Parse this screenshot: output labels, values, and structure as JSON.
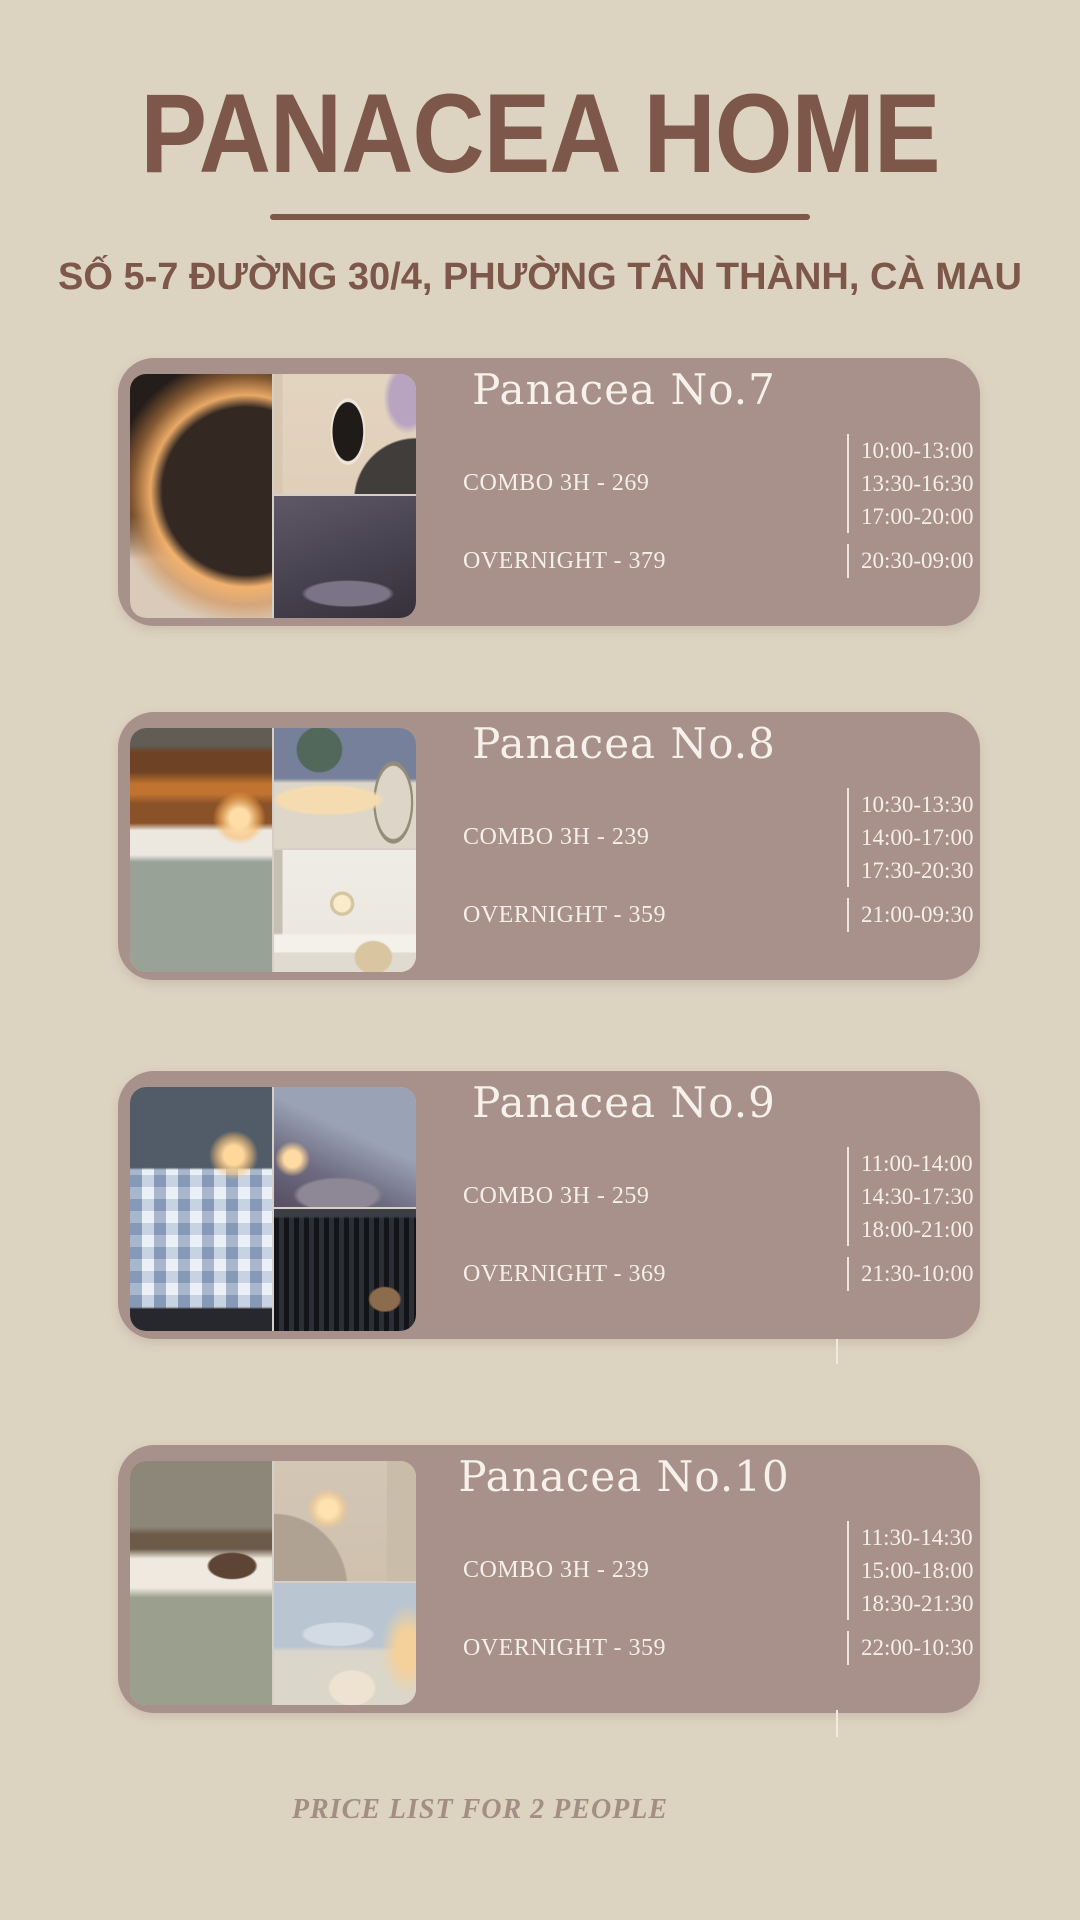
{
  "colors": {
    "background": "#ddd3c1",
    "accent_brown": "#7d5749",
    "card_background": "#a7918a",
    "card_text": "#f4efe8",
    "footer_text": "#a28e82"
  },
  "header": {
    "title": "PANACEA HOME",
    "address": "SỐ 5-7 ĐƯỜNG 30/4, PHƯỜNG TÂN THÀNH, CÀ MAU"
  },
  "rooms": [
    {
      "name": "Panacea No.7",
      "combo_label": "COMBO 3H - 269",
      "combo_times": [
        "10:00-13:00",
        "13:30-16:30",
        "17:00-20:00"
      ],
      "overnight_label": "OVERNIGHT - 379",
      "overnight_time": "20:30-09:00",
      "photo_labels": [
        "bedroom-arc-light-tufted-bed",
        "wavy-mirror-clothes-rack",
        "dark-stone-bathtub"
      ]
    },
    {
      "name": "Panacea No.8",
      "combo_label": "COMBO 3H - 239",
      "combo_times": [
        "10:30-13:30",
        "14:00-17:00",
        "17:30-20:30"
      ],
      "overnight_label": "OVERNIGHT - 359",
      "overnight_time": "21:00-09:30",
      "photo_labels": [
        "wood-headboard-bed-lamp",
        "projector-wall-arch-mirror",
        "white-vanity-desk"
      ]
    },
    {
      "name": "Panacea No.9",
      "combo_label": "COMBO 3H - 259",
      "combo_times": [
        "11:00-14:00",
        "14:30-17:30",
        "18:00-21:00"
      ],
      "overnight_label": "OVERNIGHT - 369",
      "overnight_time": "21:30-10:00",
      "photo_labels": [
        "gingham-bed-lamp",
        "dusk-window-couch",
        "dark-curtain-suitcase"
      ]
    },
    {
      "name": "Panacea No.10",
      "combo_label": "COMBO 3H - 239",
      "combo_times": [
        "11:30-14:30",
        "15:00-18:00",
        "18:30-21:30"
      ],
      "overnight_label": "OVERNIGHT - 359",
      "overnight_time": "22:00-10:30",
      "photo_labels": [
        "sage-bed-pillows",
        "lamp-dresser-bedroom",
        "city-window-cream-chair"
      ]
    }
  ],
  "footer": {
    "note": "PRICE LIST FOR 2 PEOPLE"
  }
}
